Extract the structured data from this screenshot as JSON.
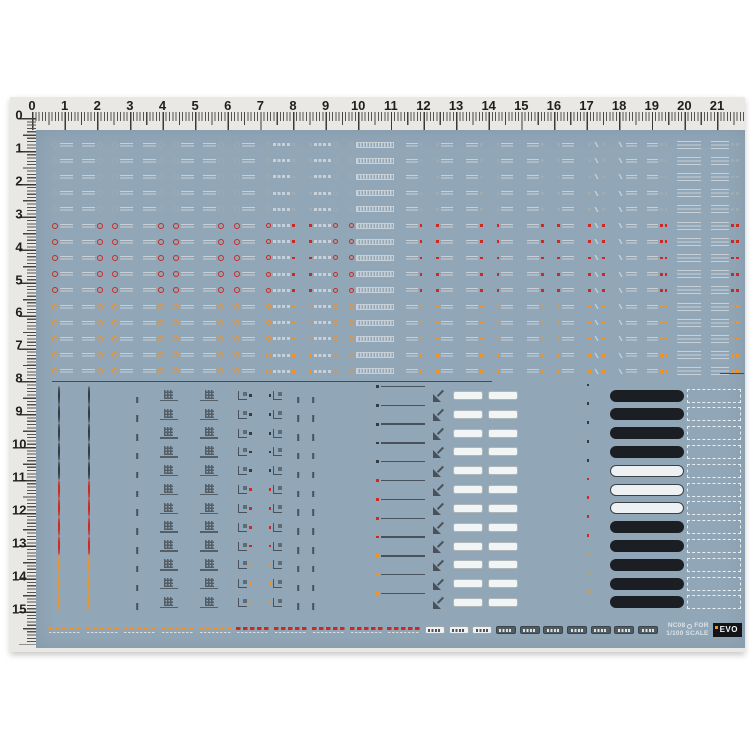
{
  "product": {
    "type": "waterslide-decal-sheet",
    "code": "NC08",
    "brand": "EVO",
    "scale": "1/100"
  },
  "colors": {
    "page_bg": "#ffffff",
    "ruler_bg": "#e9e8e4",
    "sheet_bg": "#91a6b6",
    "divider": "#454b51",
    "ink_top": "#c6d0d6",
    "ink_low": "#49525a",
    "acc_gray_top": "#9fabb2",
    "acc_gray_low": "#343b41",
    "acc_red": "#cf281e",
    "acc_orange": "#ee9229",
    "panel_dark": "#1b1f23",
    "panel_light": "#eef1f3"
  },
  "rulers": {
    "top_numbers": [
      "0",
      "1",
      "2",
      "3",
      "4",
      "5",
      "6",
      "7",
      "8",
      "9",
      "10",
      "11",
      "12",
      "13",
      "14",
      "15",
      "16",
      "17",
      "18",
      "19",
      "20",
      "21"
    ],
    "left_numbers": [
      "0",
      "1",
      "2",
      "3",
      "4",
      "5",
      "6",
      "7",
      "8",
      "9",
      "10",
      "11",
      "12",
      "13",
      "14",
      "15"
    ],
    "unit": "cm"
  },
  "top_section": {
    "rows": [
      {
        "variant": "gray"
      },
      {
        "variant": "gray"
      },
      {
        "variant": "gray"
      },
      {
        "variant": "gray"
      },
      {
        "variant": "gray"
      },
      {
        "variant": "red"
      },
      {
        "variant": "red"
      },
      {
        "variant": "red"
      },
      {
        "variant": "red"
      },
      {
        "variant": "red"
      },
      {
        "variant": "orange"
      },
      {
        "variant": "orange"
      },
      {
        "variant": "orange"
      },
      {
        "variant": "orange"
      },
      {
        "variant": "orange"
      }
    ],
    "columns": [
      "circle-dash",
      "dash-circle",
      "circle-dash",
      "dash-circle",
      "circle-dash",
      "dash-circle",
      "circle-dash",
      "circle-bar-square",
      "square-bar-circle",
      "circle-hatch-bar",
      "dash-dot",
      "dot-dash",
      "dash-dot",
      "dot-dash",
      "dash-dot",
      "dot-dash",
      "dots-arrow",
      "arrow-dash",
      "dash-dots",
      "stack-lines",
      "stack-dots"
    ]
  },
  "lower_section": {
    "rows": [
      {
        "variant": "gray",
        "panel": "dark-left"
      },
      {
        "variant": "gray",
        "panel": "dark-left"
      },
      {
        "variant": "gray",
        "panel": "dark-right"
      },
      {
        "variant": "gray",
        "panel": "dark-right"
      },
      {
        "variant": "gray",
        "panel": "light-left"
      },
      {
        "variant": "red",
        "panel": "light-left"
      },
      {
        "variant": "red",
        "panel": "light-left"
      },
      {
        "variant": "red",
        "panel": "dark-left"
      },
      {
        "variant": "red",
        "panel": "dark-right"
      },
      {
        "variant": "orange",
        "panel": "dark-right"
      },
      {
        "variant": "orange",
        "panel": "dark-right"
      },
      {
        "variant": "orange",
        "panel": "dark-left"
      }
    ],
    "columns": [
      "roundel-large",
      "roundel-small",
      "bracket-dot",
      "bracket-tee",
      "grid-pair",
      "grid-pair2",
      "step-square",
      "square-step",
      "tee-mark",
      "tee-mark2",
      "text-dot",
      "dot-text",
      "text-line-long",
      "arrow-diagonal",
      "pill-label",
      "pill-label2",
      "hazard-bar",
      "black-panel",
      "dashed-box"
    ]
  },
  "bottom_strip": {
    "dash_groups": [
      {
        "color": "orange"
      },
      {
        "color": "orange"
      },
      {
        "color": "orange"
      },
      {
        "color": "orange"
      },
      {
        "color": "orange"
      },
      {
        "color": "red"
      },
      {
        "color": "red"
      },
      {
        "color": "red"
      },
      {
        "color": "red"
      },
      {
        "color": "red"
      }
    ],
    "pills": [
      {
        "style": "white"
      },
      {
        "style": "white"
      },
      {
        "style": "white"
      },
      {
        "style": "dark"
      },
      {
        "style": "dark"
      },
      {
        "style": "dark"
      },
      {
        "style": "dark"
      },
      {
        "style": "dark"
      },
      {
        "style": "dark"
      },
      {
        "style": "dark"
      }
    ],
    "note": {
      "line1_prefix": "NC08",
      "line1_suffix": "FOR",
      "line2": "1/100 SCALE"
    },
    "logo_text": "EVO"
  }
}
